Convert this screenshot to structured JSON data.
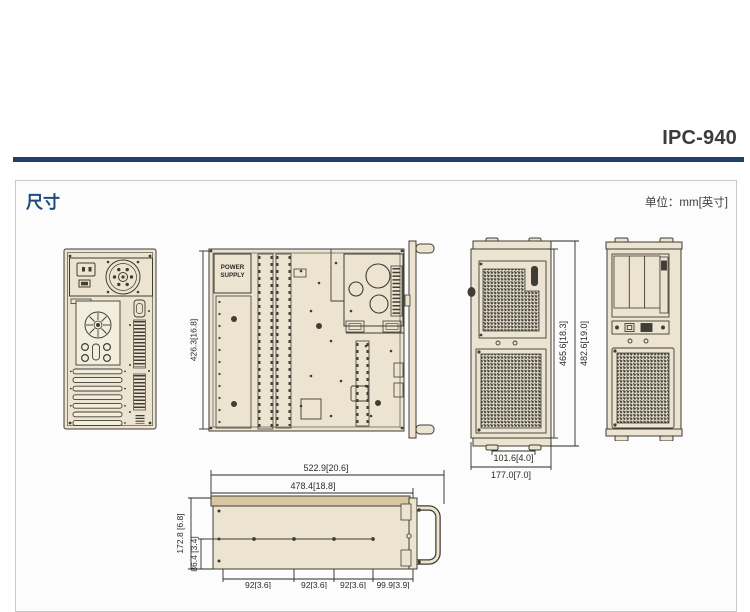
{
  "header": {
    "product_code": "IPC-940"
  },
  "panel": {
    "title": "尺寸",
    "unit_label": "单位：mm[英寸]"
  },
  "views": {
    "top": {
      "power_supply_line1": "POWER",
      "power_supply_line2": "SUPPLY",
      "depth_dim": "426.3[16.8]"
    },
    "front_rotated": {
      "body_height_dim": "465.6[18.3]",
      "overall_height_dim": "482.6[19.0]",
      "foot_spacing_dim": "101.6[4.0]",
      "width_dim": "177.0[7.0]"
    },
    "side_profile": {
      "overall_width_dim": "522.9[20.6]",
      "inner_width_dim": "478.4[18.8]",
      "height_dim": "172.8 [6.8]",
      "half_height_dim": "86.4 [3.4]",
      "segment_dims": [
        "92[3.6]",
        "92[3.6]",
        "92[3.6]",
        "99.9[3.9]"
      ]
    }
  },
  "colors": {
    "accent_line": "#20406b",
    "heading_blue": "#1c4b7d",
    "chassis_fill": "#ece4d0",
    "plate_fill": "#f3eddd",
    "top_strip_tan": "#d9c7a1",
    "line_dark": "#3f3d35",
    "mesh_dark": "#43413a"
  }
}
